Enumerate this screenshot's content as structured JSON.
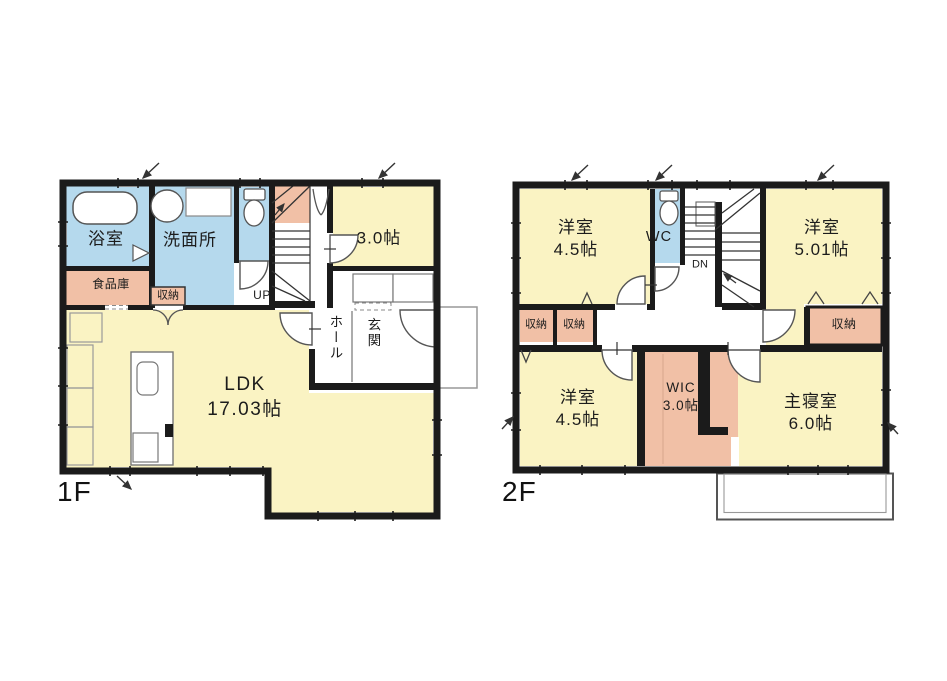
{
  "document": {
    "kind": "japanese-residential-floor-plan",
    "background": "#ffffff"
  },
  "colors": {
    "room_yellow": "#faf3c3",
    "water_blue": "#b5d9ed",
    "storage_salmon": "#f1c0a6",
    "wall_black": "#1b1b1b",
    "thin_line_gray": "#777777"
  },
  "floor1": {
    "label": "1F",
    "rooms": {
      "bathroom": "浴室",
      "washroom": "洗面所",
      "pantry": "食品庫",
      "closet": "収納",
      "stairs": "UP",
      "room3": "3.0帖",
      "hall": "ホール",
      "entrance": "玄関",
      "ldk_name": "LDK",
      "ldk_size": "17.03帖"
    }
  },
  "floor2": {
    "label": "2F",
    "rooms": {
      "room_tl_name": "洋室",
      "room_tl_size": "4.5帖",
      "wc": "WC",
      "stairs": "DN",
      "room_tr_name": "洋室",
      "room_tr_size": "5.01帖",
      "closet_left1": "収納",
      "closet_left2": "収納",
      "closet_right": "収納",
      "room_bl_name": "洋室",
      "room_bl_size": "4.5帖",
      "wic_name": "WIC",
      "wic_size": "3.0帖",
      "master_name": "主寝室",
      "master_size": "6.0帖"
    }
  }
}
